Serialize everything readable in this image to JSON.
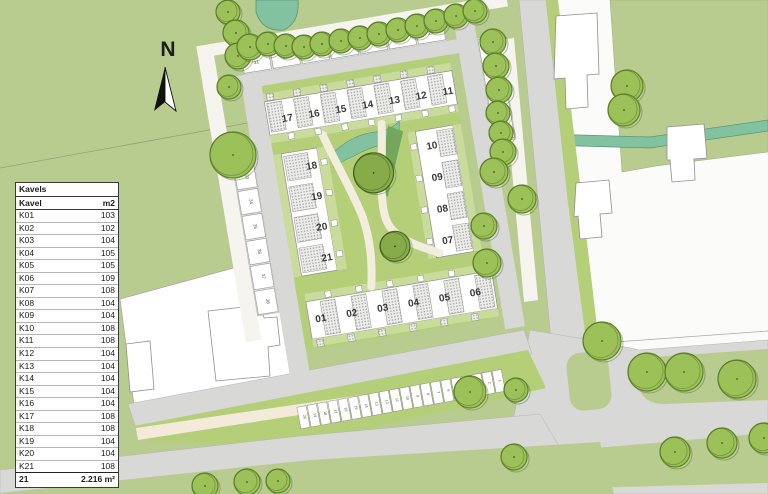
{
  "compass": {
    "label": "N"
  },
  "table": {
    "title": "Kavels",
    "col_kavel": "Kavel",
    "col_m2": "m2",
    "rows": [
      {
        "kavel": "K01",
        "m2": "103"
      },
      {
        "kavel": "K02",
        "m2": "102"
      },
      {
        "kavel": "K03",
        "m2": "104"
      },
      {
        "kavel": "K04",
        "m2": "105"
      },
      {
        "kavel": "K05",
        "m2": "105"
      },
      {
        "kavel": "K06",
        "m2": "109"
      },
      {
        "kavel": "K07",
        "m2": "108"
      },
      {
        "kavel": "K08",
        "m2": "104"
      },
      {
        "kavel": "K09",
        "m2": "104"
      },
      {
        "kavel": "K10",
        "m2": "108"
      },
      {
        "kavel": "K11",
        "m2": "108"
      },
      {
        "kavel": "K12",
        "m2": "104"
      },
      {
        "kavel": "K13",
        "m2": "104"
      },
      {
        "kavel": "K14",
        "m2": "104"
      },
      {
        "kavel": "K15",
        "m2": "104"
      },
      {
        "kavel": "K16",
        "m2": "104"
      },
      {
        "kavel": "K17",
        "m2": "108"
      },
      {
        "kavel": "K18",
        "m2": "108"
      },
      {
        "kavel": "K19",
        "m2": "104"
      },
      {
        "kavel": "K20",
        "m2": "104"
      },
      {
        "kavel": "K21",
        "m2": "108"
      }
    ],
    "total_count": "21",
    "total_area": "2.216 m²"
  },
  "site": {
    "top_row": [
      "17",
      "16",
      "15",
      "14",
      "13",
      "12",
      "11"
    ],
    "left_col": [
      "18",
      "19",
      "20",
      "21"
    ],
    "right_col": [
      "10",
      "09",
      "08",
      "07"
    ],
    "bottom_row": [
      "01",
      "02",
      "03",
      "04",
      "05",
      "06"
    ]
  },
  "parking": {
    "top": [
      "31",
      "30",
      "29",
      "28",
      "27",
      "26",
      "25"
    ],
    "left": [
      "32",
      "33",
      "34",
      "35",
      "36",
      "37",
      "38"
    ],
    "right": [
      "24",
      "23",
      "22",
      "21"
    ],
    "bottom": [
      "20",
      "19",
      "18",
      "17",
      "16",
      "15",
      "14",
      "13",
      "12",
      "11",
      "10",
      "9",
      "8",
      "7",
      "6",
      "5",
      "4",
      "3",
      "2",
      "1"
    ]
  },
  "colors": {
    "field_green": "#b9cc90",
    "site_green": "#b4cf78",
    "garden_green": "#cadc9c",
    "water_teal": "#83c2a1",
    "tree_green": "#9dc159",
    "tree_dark": "#88ab4a",
    "road_gray": "#d8d8d6",
    "parking_gray": "#dcdcda",
    "path_cream": "#f3ead9",
    "white": "#ffffff"
  }
}
